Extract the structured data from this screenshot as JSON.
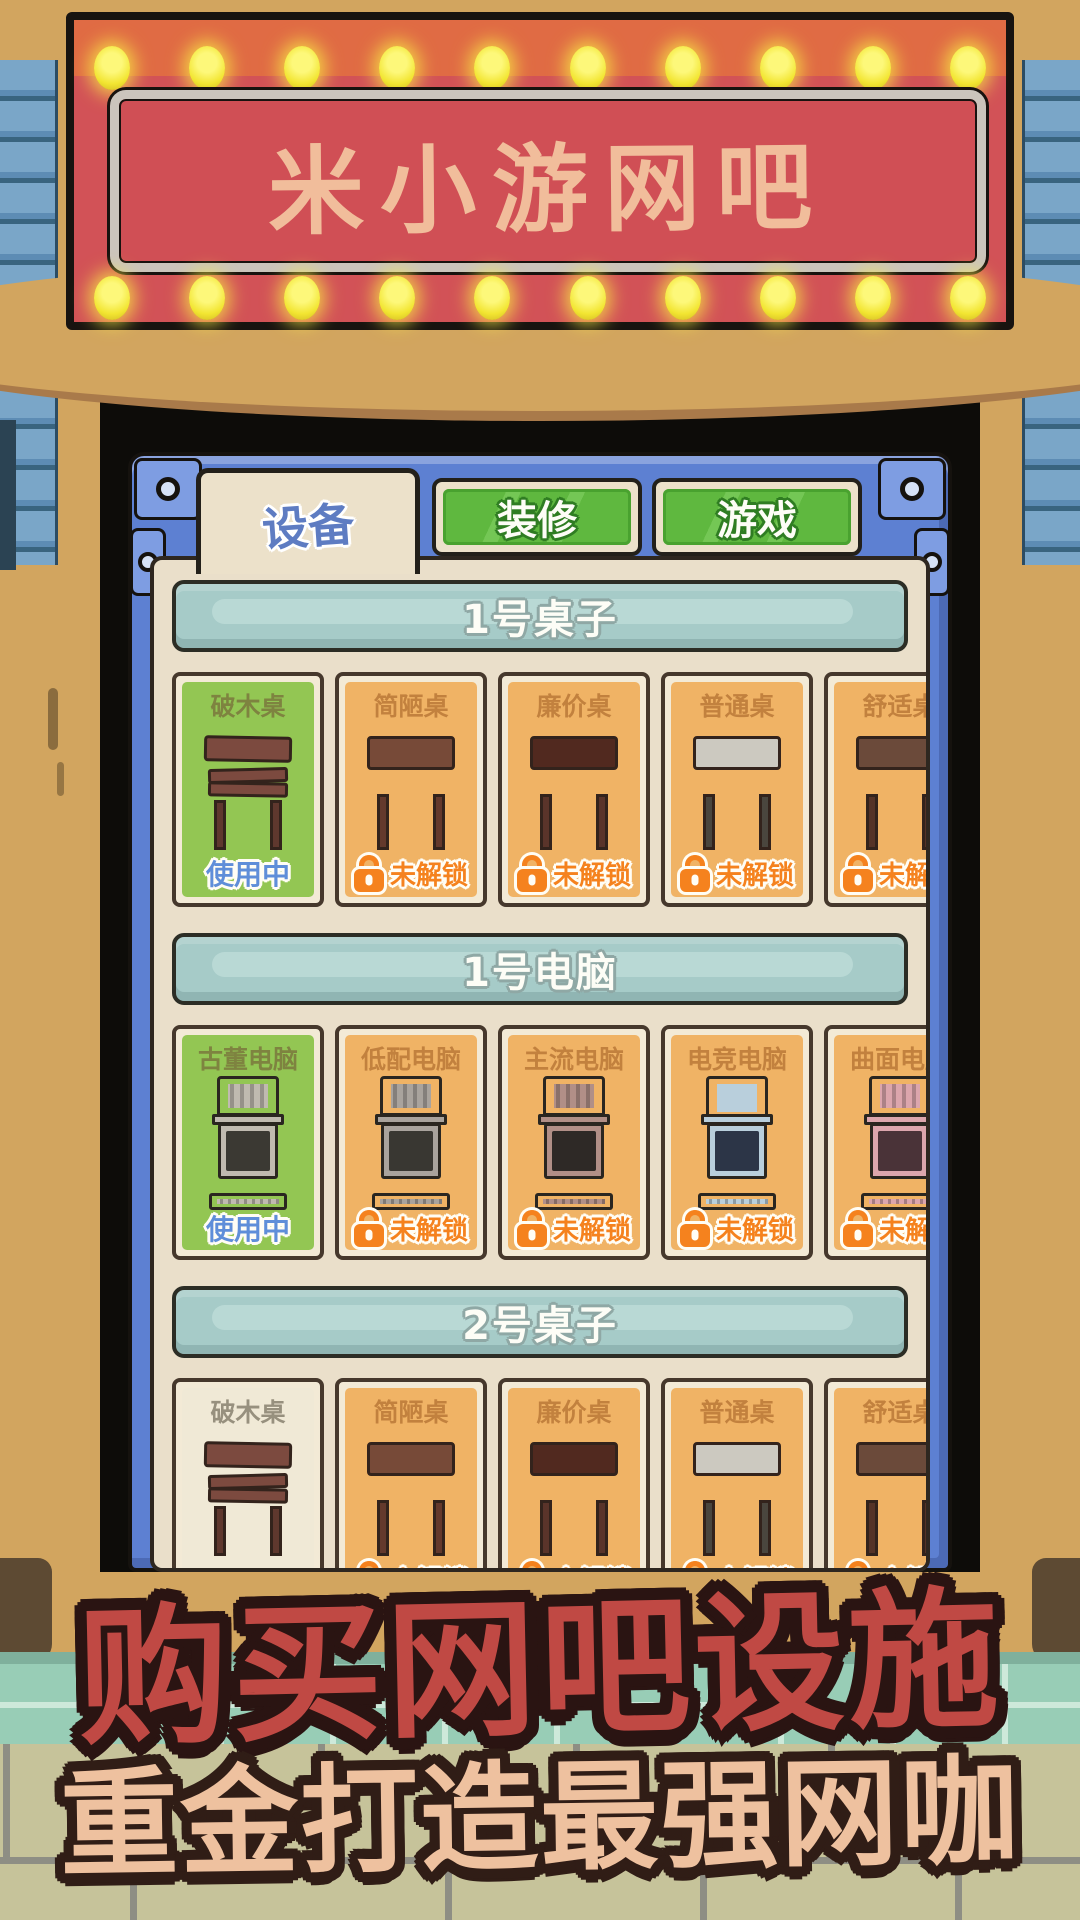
{
  "sign": {
    "title": "米小游网吧"
  },
  "tabs": [
    {
      "label": "设备",
      "active": true
    },
    {
      "label": "装修",
      "active": false
    },
    {
      "label": "游戏",
      "active": false
    }
  ],
  "sections": [
    {
      "title": "1号桌子",
      "cards": [
        {
          "name": "破木桌",
          "status": "使用中",
          "state": "in-use"
        },
        {
          "name": "简陋桌",
          "status": "未解锁",
          "state": "locked"
        },
        {
          "name": "廉价桌",
          "status": "未解锁",
          "state": "locked"
        },
        {
          "name": "普通桌",
          "status": "未解锁",
          "state": "locked"
        },
        {
          "name": "舒适桌",
          "status": "未解锁",
          "state": "locked"
        }
      ]
    },
    {
      "title": "1号电脑",
      "cards": [
        {
          "name": "古董电脑",
          "status": "使用中",
          "state": "in-use"
        },
        {
          "name": "低配电脑",
          "status": "未解锁",
          "state": "locked"
        },
        {
          "name": "主流电脑",
          "status": "未解锁",
          "state": "locked"
        },
        {
          "name": "电竞电脑",
          "status": "未解锁",
          "state": "locked"
        },
        {
          "name": "曲面电脑",
          "status": "未解锁",
          "state": "locked"
        }
      ]
    },
    {
      "title": "2号桌子",
      "cards": [
        {
          "name": "破木桌",
          "status": "",
          "state": "owned"
        },
        {
          "name": "简陋桌",
          "status": "未解锁",
          "state": "locked"
        },
        {
          "name": "廉价桌",
          "status": "未解锁",
          "state": "locked"
        },
        {
          "name": "普通桌",
          "status": "未解锁",
          "state": "locked"
        },
        {
          "name": "舒适桌",
          "status": "未解锁",
          "state": "locked"
        }
      ]
    }
  ],
  "banner": {
    "line1": "购买网吧设施",
    "line2": "重金打造最强网咖"
  },
  "colors": {
    "sign_red": "#d25257",
    "sign_top_orange": "#e06b44",
    "bulb_yellow": "#f2e531",
    "sign_text_peach": "#f1bd9b",
    "frame_blue": "#5d80d2",
    "panel_cream": "#eadfca",
    "bar_teal": "#a6cbc8",
    "tab_green": "#5fb83f",
    "tab_active_text": "#5e7cc2",
    "card_in_use_green": "#93c653",
    "card_locked_orange": "#f0b365",
    "in_use_blue": "#5f8ed9",
    "locked_orange": "#f5821e",
    "banner_red": "#c04944",
    "banner_peach": "#eec19f"
  }
}
